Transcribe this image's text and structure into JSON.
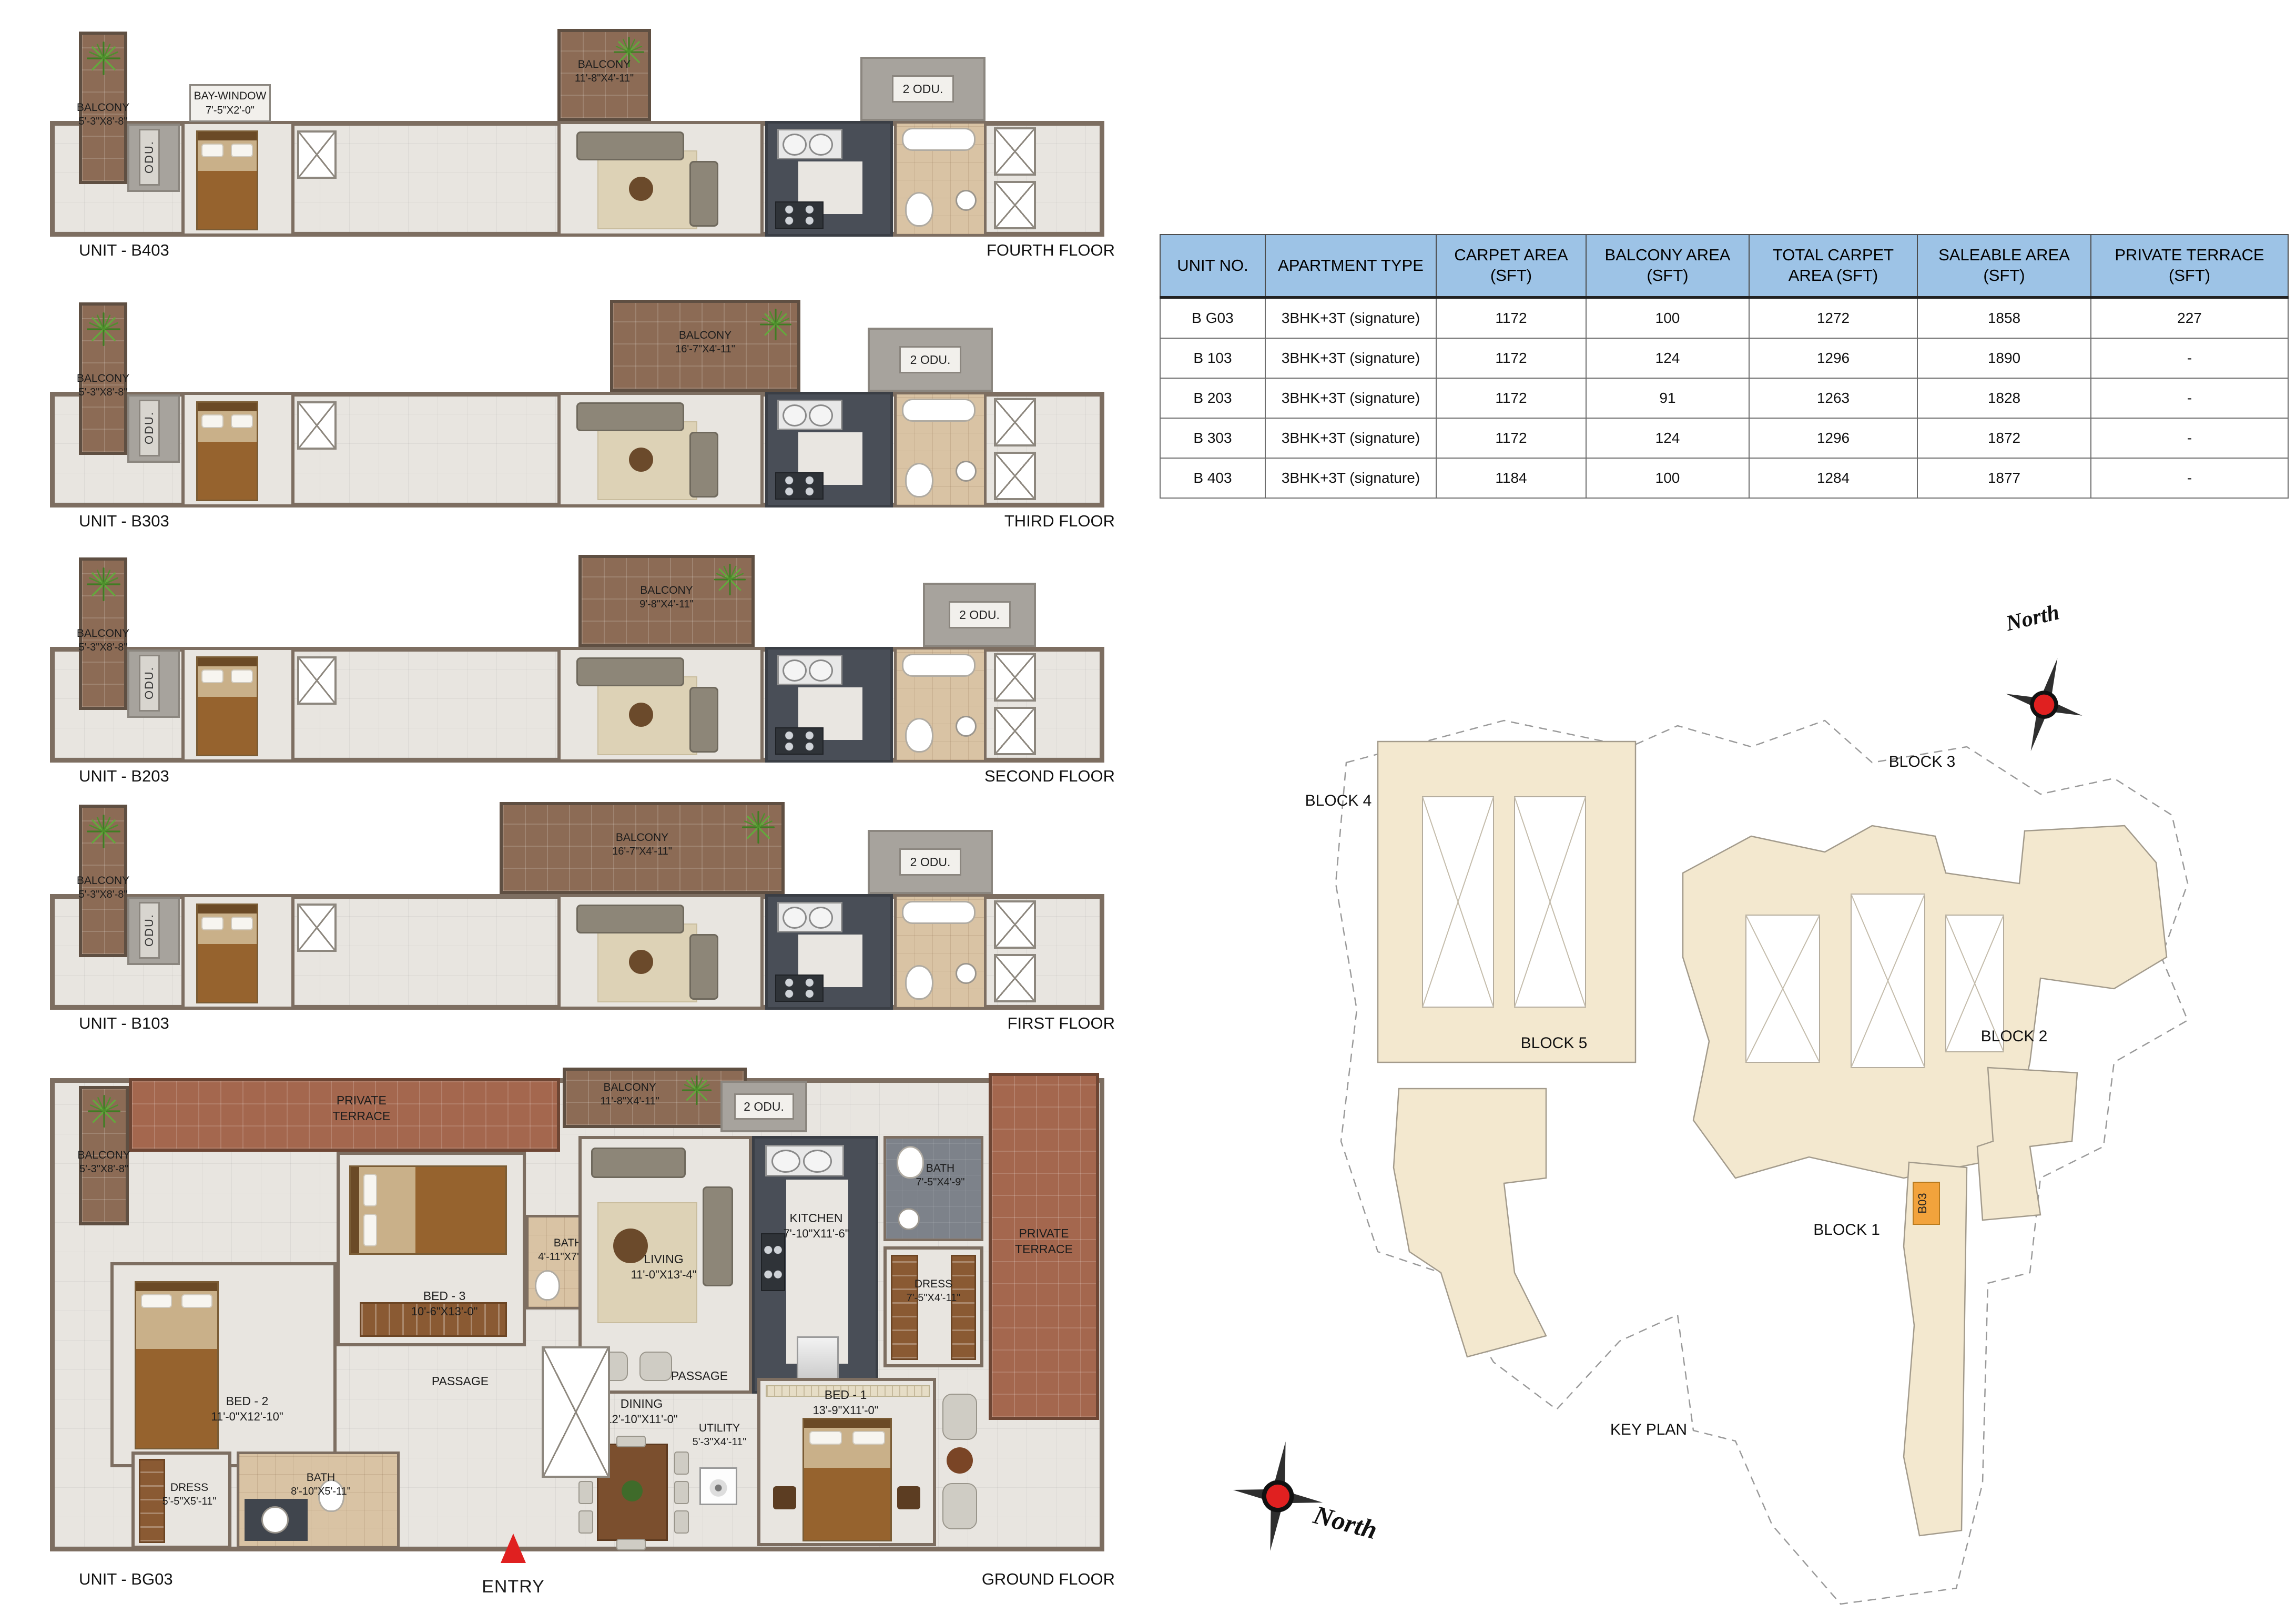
{
  "colors": {
    "header_blue": "#9dc3e6",
    "balcony_brown": "#8c6b55",
    "terrace_red": "#a4674e",
    "wall_taupe": "#7d6e61",
    "highlight_orange": "#f2a33c",
    "compass_red": "#e02020"
  },
  "floors": [
    {
      "unit": "UNIT - B403",
      "floor": "FOURTH FLOOR",
      "left_balcony": {
        "name": "BALCONY",
        "dim": "5'-3\"X8'-8\""
      },
      "odu": "ODU.",
      "odu2": "2 ODU.",
      "bay_window": {
        "name": "BAY-WINDOW",
        "dim": "7'-5\"X2'-0\""
      },
      "balcony": {
        "name": "BALCONY",
        "dim": "11'-8\"X4'-11\""
      }
    },
    {
      "unit": "UNIT - B303",
      "floor": "THIRD FLOOR",
      "left_balcony": {
        "name": "BALCONY",
        "dim": "5'-3\"X8'-8\""
      },
      "odu": "ODU.",
      "odu2": "2 ODU.",
      "balcony": {
        "name": "BALCONY",
        "dim": "16'-7\"X4'-11\""
      }
    },
    {
      "unit": "UNIT - B203",
      "floor": "SECOND FLOOR",
      "left_balcony": {
        "name": "BALCONY",
        "dim": "5'-3\"X8'-8\""
      },
      "odu": "ODU.",
      "odu2": "2 ODU.",
      "balcony": {
        "name": "BALCONY",
        "dim": "9'-8\"X4'-11\""
      }
    },
    {
      "unit": "UNIT - B103",
      "floor": "FIRST FLOOR",
      "left_balcony": {
        "name": "BALCONY",
        "dim": "5'-3\"X8'-8\""
      },
      "odu": "ODU.",
      "odu2": "2 ODU.",
      "balcony": {
        "name": "BALCONY",
        "dim": "16'-7\"X4'-11\""
      }
    }
  ],
  "ground": {
    "unit": "UNIT - BG03",
    "floor": "GROUND FLOOR",
    "entry": "ENTRY",
    "passages": [
      "PASSAGE",
      "PASSAGE"
    ],
    "rooms": {
      "left_balcony": {
        "name": "BALCONY",
        "dim": "5'-3\"X8'-8\""
      },
      "terrace_top": {
        "line1": "PRIVATE",
        "line2": "TERRACE"
      },
      "terrace_right": {
        "line1": "PRIVATE",
        "line2": "TERRACE"
      },
      "odu": "ODU.",
      "odu2": "2 ODU.",
      "balcony": {
        "name": "BALCONY",
        "dim": "11'-8\"X4'-11\""
      },
      "bed3": {
        "name": "BED - 3",
        "dim": "10'-6\"X13'-0\""
      },
      "bath3": {
        "name": "BATH",
        "dim": "4'-11\"X7'-10\""
      },
      "bed2": {
        "name": "BED - 2",
        "dim": "11'-0\"X12'-10\""
      },
      "dress2": {
        "name": "DRESS",
        "dim": "5'-5\"X5'-11\""
      },
      "bath2": {
        "name": "BATH",
        "dim": "8'-10\"X5'-11\""
      },
      "living": {
        "name": "LIVING",
        "dim": "11'-0\"X13'-4\""
      },
      "kitchen": {
        "name": "KITCHEN",
        "dim": "7'-10\"X11'-6\""
      },
      "bath1": {
        "name": "BATH",
        "dim": "7'-5\"X4'-9\""
      },
      "dress1": {
        "name": "DRESS",
        "dim": "7'-5\"X4'-11\""
      },
      "dining": {
        "name": "DINING",
        "dim": "12'-10\"X11'-0\""
      },
      "utility": {
        "name": "UTILITY",
        "dim": "5'-3\"X4'-11\""
      },
      "bed1": {
        "name": "BED - 1",
        "dim": "13'-9\"X11'-0\""
      }
    }
  },
  "table": {
    "headers": [
      "UNIT NO.",
      "APARTMENT TYPE",
      "CARPET AREA (SFT)",
      "BALCONY AREA (SFT)",
      "TOTAL CARPET AREA (SFT)",
      "SALEABLE AREA (SFT)",
      "PRIVATE TERRACE (SFT)"
    ],
    "rows": [
      [
        "B G03",
        "3BHK+3T (signature)",
        "1172",
        "100",
        "1272",
        "1858",
        "227"
      ],
      [
        "B 103",
        "3BHK+3T (signature)",
        "1172",
        "124",
        "1296",
        "1890",
        "-"
      ],
      [
        "B 203",
        "3BHK+3T (signature)",
        "1172",
        "91",
        "1263",
        "1828",
        "-"
      ],
      [
        "B 303",
        "3BHK+3T (signature)",
        "1172",
        "124",
        "1296",
        "1872",
        "-"
      ],
      [
        "B 403",
        "3BHK+3T (signature)",
        "1184",
        "100",
        "1284",
        "1877",
        "-"
      ]
    ]
  },
  "keyplan": {
    "title": "KEY PLAN",
    "north": "North",
    "highlight": "B03",
    "blocks": {
      "b1": "BLOCK 1",
      "b2": "BLOCK 2",
      "b3": "BLOCK 3",
      "b4": "BLOCK 4",
      "b5": "BLOCK 5"
    }
  }
}
